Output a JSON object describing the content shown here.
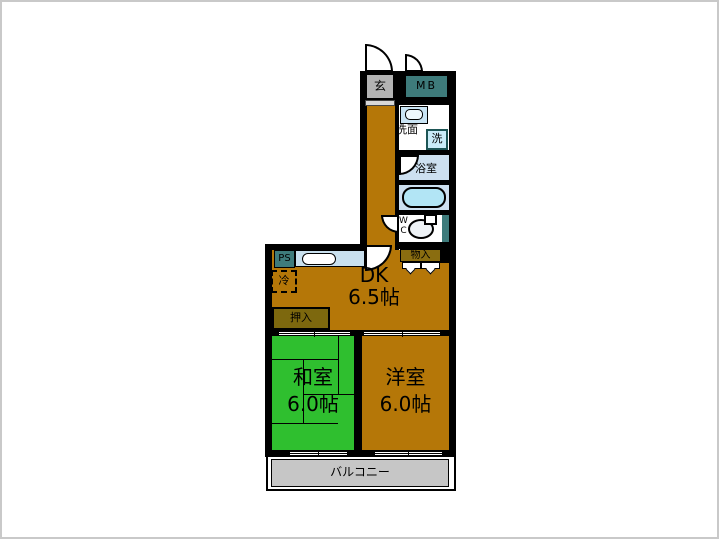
{
  "plan": {
    "entrance": "玄",
    "meter_box": "MB",
    "washroom": "洗面",
    "washing_machine": "洗",
    "bathroom": "浴室",
    "wc_line1": "W",
    "wc_line2": "C",
    "storage": "物入",
    "pipe_shaft": "PS",
    "refrigerator": "冷",
    "dining_kitchen": "DK",
    "dining_kitchen_size": "6.5帖",
    "closet": "押入",
    "japanese_room": "和室",
    "japanese_room_size": "6.0帖",
    "western_room": "洋室",
    "western_room_size": "6.0帖",
    "balcony": "バルコニー"
  },
  "colors": {
    "wall": "#000000",
    "flooring": "#b57708",
    "tatami_green": "#2fbf2f",
    "teal_fixture": "#3e7b7b",
    "bath_floor": "#cde0f0",
    "bathtub": "#b2e5f5",
    "kitchen_counter": "#c9e0ee",
    "closet_fill": "#7d680e",
    "storage_fill": "#8a6d10",
    "entrance_fill": "#b3b3b3",
    "balcony_fill": "#c6c6c6"
  }
}
